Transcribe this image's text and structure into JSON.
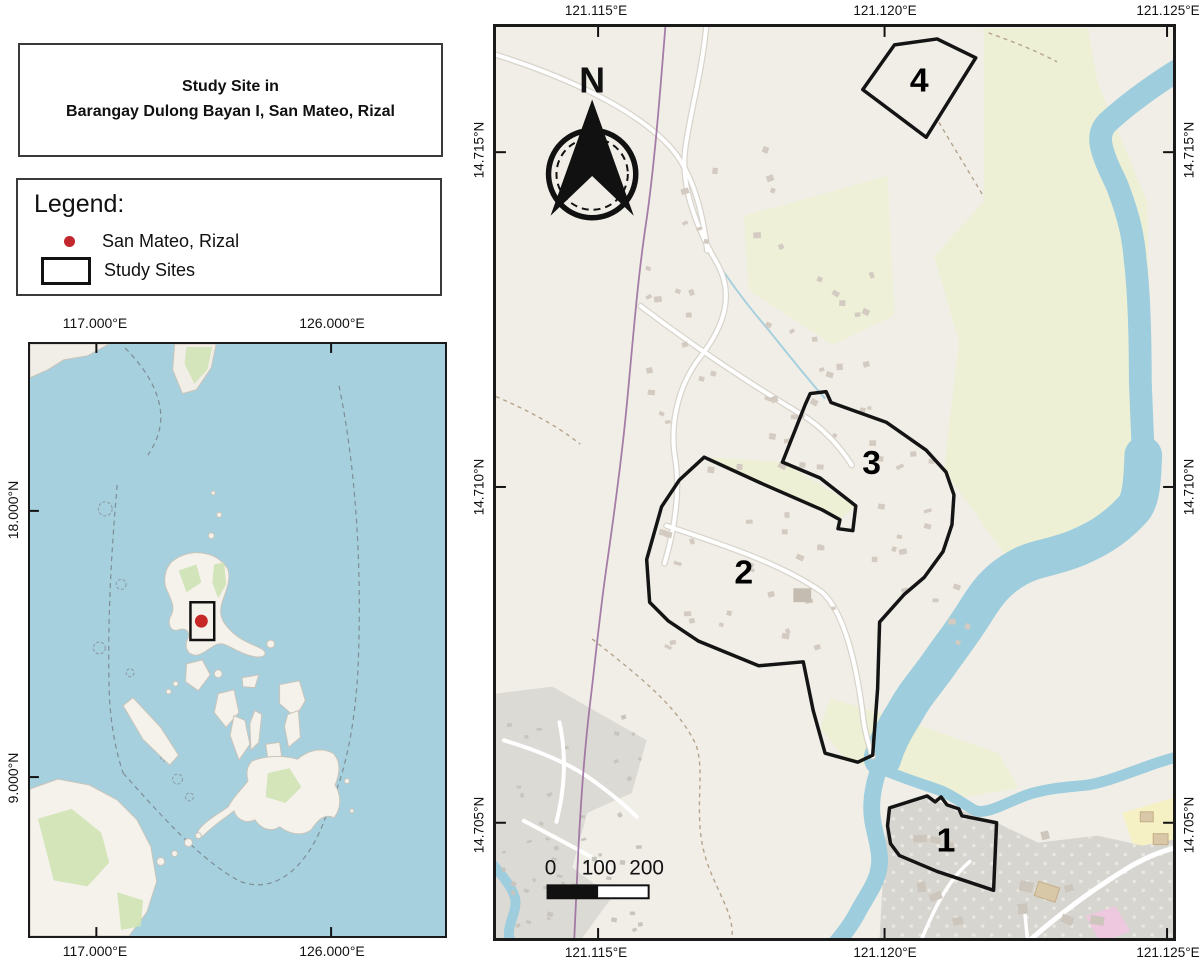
{
  "figure": {
    "title_line1": "Study Site in",
    "title_line2": "Barangay Dulong Bayan I, San Mateo, Rizal"
  },
  "legend": {
    "heading": "Legend:",
    "items": [
      {
        "marker": "red-dot",
        "label": "San Mateo, Rizal"
      },
      {
        "marker": "rectangle-outline",
        "label": "Study Sites"
      }
    ]
  },
  "inset_map": {
    "lon_labels": [
      "117.000°E",
      "126.000°E"
    ],
    "lat_labels": [
      "18.000°N",
      "9.000°N"
    ],
    "marker": "San Mateo, Rizal location"
  },
  "main_map": {
    "lon_labels": [
      "121.115°E",
      "121.120°E",
      "121.125°E"
    ],
    "lat_labels": [
      "14.715°N",
      "14.710°N",
      "14.705°N"
    ],
    "north_label": "N",
    "scale_bar": {
      "labels": [
        "0",
        "100",
        "200"
      ]
    },
    "site_labels": [
      "1",
      "2",
      "3",
      "4"
    ]
  },
  "colors": {
    "water": "#a6d0de",
    "land": "#f1eee7",
    "field_green": "#eef0d5",
    "urban_gray": "#d9d7d2",
    "road": "#ffffff",
    "boundary_purple": "#96679b",
    "site_outline": "#141414",
    "marker_red": "#c62828"
  }
}
